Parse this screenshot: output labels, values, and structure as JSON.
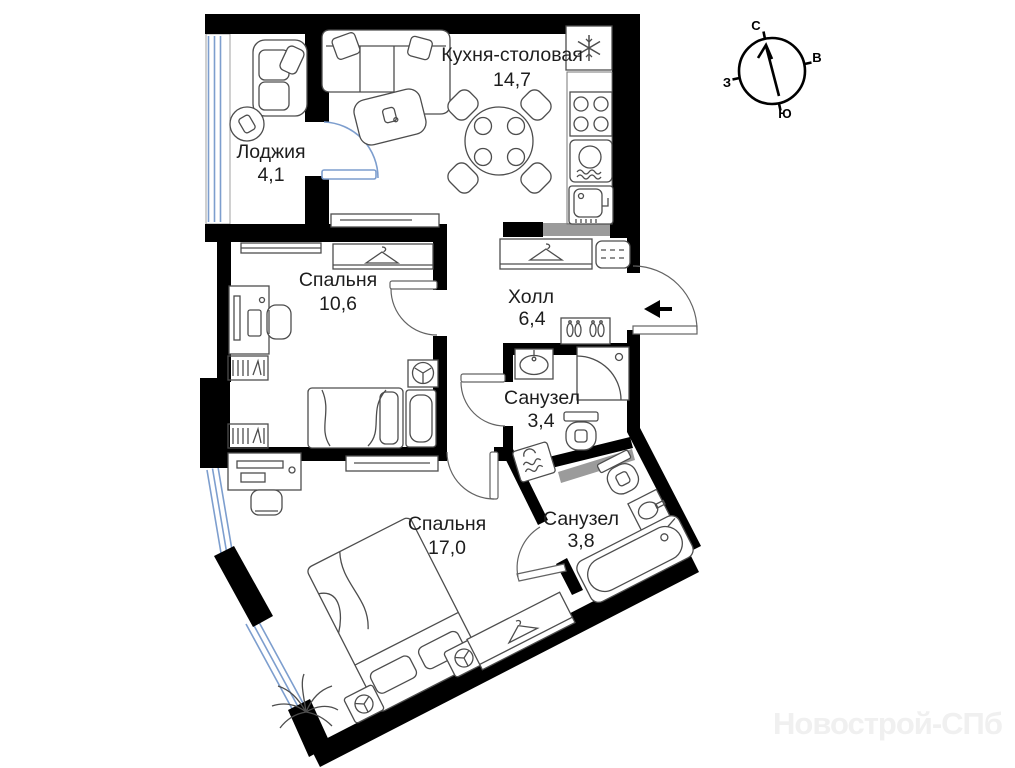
{
  "rooms": {
    "loggia": {
      "name": "Лоджия",
      "area": "4,1"
    },
    "kitchen": {
      "name": "Кухня-столовая",
      "area": "14,7"
    },
    "bedroom_small": {
      "name": "Спальня",
      "area": "10,6"
    },
    "hall": {
      "name": "Холл",
      "area": "6,4"
    },
    "bathroom_small": {
      "name": "Санузел",
      "area": "3,4"
    },
    "bedroom_big": {
      "name": "Спальня",
      "area": "17,0"
    },
    "bathroom_big": {
      "name": "Санузел",
      "area": "3,8"
    }
  },
  "compass": {
    "north": "С",
    "east": "В",
    "south": "Ю",
    "west": "З"
  },
  "watermark": "Новострой-СПб",
  "colors": {
    "wall": "#000000",
    "window": "#7d9ece",
    "door": "#636363",
    "furniture": "#4d4d4d",
    "vent": "#9b9b9b",
    "label": "#1d1d1d",
    "watermark": "#f0f0f0",
    "background": "#ffffff"
  },
  "icons": [
    "compass-rose-icon",
    "entrance-arrow-icon",
    "fridge-icon",
    "stove-icon",
    "washing-machine-icon",
    "kitchen-sink-icon",
    "dining-table-icon",
    "dining-chair-icon",
    "sofa-icon",
    "coffee-table-icon",
    "armchair-icon",
    "side-table-icon",
    "sideboard-icon",
    "wardrobe-icon",
    "hanger-icon",
    "shoe-rack-icon",
    "cabinet-icon",
    "bathroom-sink-icon",
    "shower-icon",
    "toilet-icon",
    "bathtub-icon",
    "bed-icon",
    "nightstand-lamp-icon",
    "desk-icon",
    "chair-icon",
    "bookshelf-icon",
    "tv-icon",
    "radiator-icon",
    "plant-icon",
    "door-arc-icon",
    "window-glazing-icon",
    "vent-shaft"
  ]
}
